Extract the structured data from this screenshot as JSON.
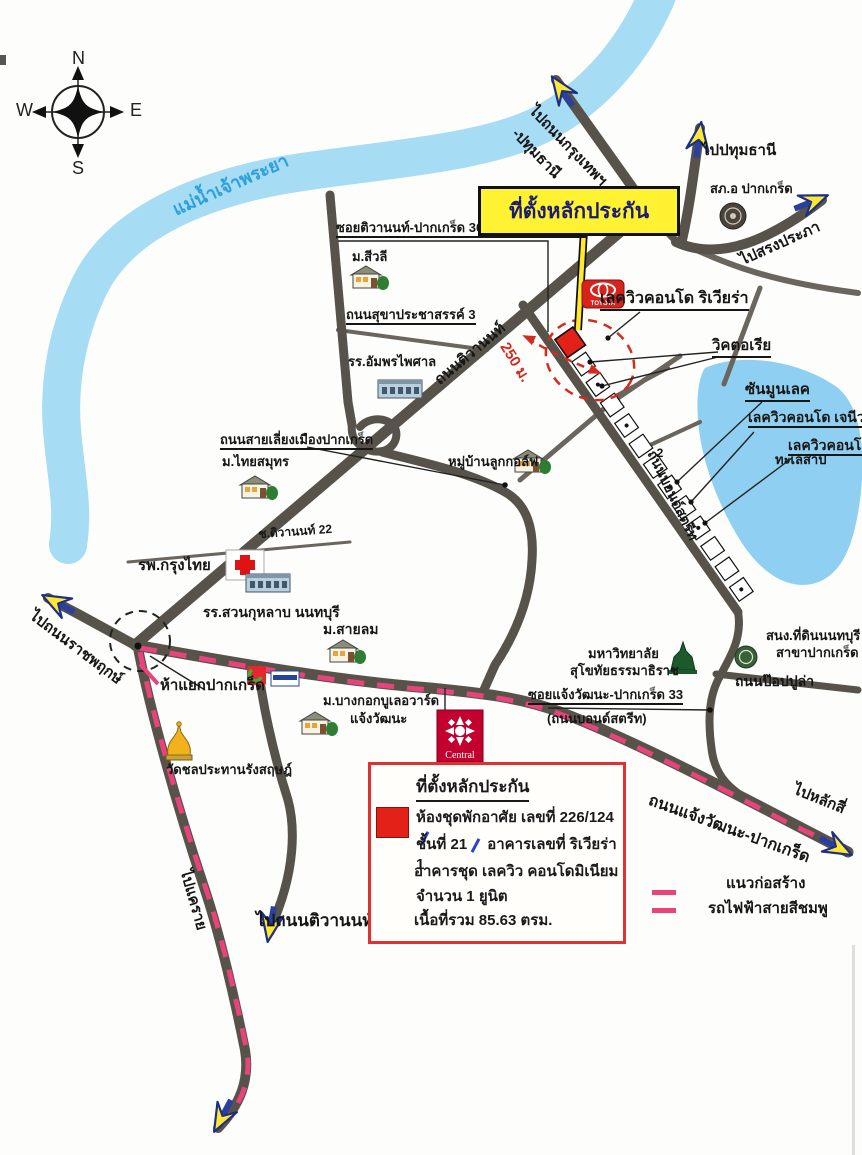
{
  "compass": {
    "north": "N",
    "south": "S",
    "east": "E",
    "west": "W"
  },
  "river_label": "แม่น้ำเจ้าพระยา",
  "title_box": "ที่ตั้งหลักประกัน",
  "directions": {
    "to_bangkok_line1": "ไปถนนกรุงเทพฯ",
    "to_bangkok_line2": "-ปทุมธานี",
    "to_pathumthani": "ไปปทุมธานี",
    "to_songprapha": "ไปสรงประภา",
    "to_ratchaphruek": "ไปถนนราชพฤกษ์",
    "to_laksi": "ไปหลักสี่",
    "to_khaerai": "ไปแคราย",
    "to_tiwanon_road": "ไปถนนติวานนท์"
  },
  "roads": {
    "soi_tiwanon_36": "ซอยติวานนท์-ปากเกร็ด 36 (ถนนบอนด์สตรีท)",
    "sukhaprachasan_3": "ถนนสุขาประชาสรรค์ 3",
    "tiwanon": "ถนนติวานนท์",
    "distance_250m": "250 ม.",
    "bypass": "ถนนสายเลี่ยงเมืองปากเกร็ด",
    "soi_tiwanon_22": "ช.ติวานนท์ 22",
    "bond_street": "ถนนบอนด์สตรีท",
    "chaengwattana": "ถนนแจ้งวัฒนะ-ปากเกร็ด",
    "popular": "ถนนป๊อปปูล่า",
    "soi_chaengwattana_33": "ซอยแจ้งวัฒนะ-ปากเกร็ด 33",
    "soi_chaengwattana_33_sub": "(ถนนบอนด์สตรีท)"
  },
  "places": {
    "police_station": "สภ.อ ปากเกร็ด",
    "sivalee_village": "ม.สีวลี",
    "amphon_school": "รร.อัมพรไพศาล",
    "lakeview_riviera": "เลควิวคอนโด ริเวียร่า",
    "victoria": "วิคตอเรีย",
    "sun_moon_lake": "ซันมูนเลค",
    "lakeview_geneva": "เลควิวคอนโด เจนีวา",
    "lakeview_condo": "เลควิวคอนโด",
    "lake": "ทะเลสาป",
    "thai_samut_village": "ม.ไทยสมุทร",
    "golf_village": "หมู่บ้านลูกกอล์ฟ",
    "krungthai_hospital": "รพ.กรุงไทย",
    "suankularb_school": "รร.สวนกุหลาบ นนทบุรี",
    "sailom_village": "ม.สายลม",
    "pakkret_junction": "ห้าแยกปากเกร็ด",
    "wat_chonprathan": "วัดชลประทานรังสฤษฎ์",
    "bangkok_boulevard_line1": "ม.บางกอกบูเลอวาร์ด",
    "bangkok_boulevard_line2": "แจ้งวัฒนะ",
    "stou_line1": "มหาวิทยาลัย",
    "stou_line2": "สุโขทัยธรรมาธิราช",
    "land_office_line1": "สนง.ที่ดินนนทบุรี",
    "land_office_line2": "สาขาปากเกร็ด",
    "block_2": "2",
    "toyota": "TOYOTA",
    "central": "Central"
  },
  "legend": {
    "line1": "แนวก่อสร้าง",
    "line2": "รถไฟฟ้าสายสีชมพู"
  },
  "info_box": {
    "title": "ที่ตั้งหลักประกัน",
    "line1": "ห้องชุดพักอาศัย เลขที่ 226/124",
    "line2a": "ชั้นที่ 21",
    "line2b": "อาคารเลขที่ ริเวียร่า 1",
    "line3": "อาคารชุด เลควิว คอนโดมิเนียม",
    "line4": "จำนวน 1 ยูนิต",
    "line5": "เนื้อที่รวม 85.63 ตรม."
  },
  "colors": {
    "river": "#a6dcf4",
    "lake": "#8fd0f2",
    "road": "#57534b",
    "pink_line": "#e8437a",
    "marker_red": "#e32119",
    "highlight_yellow": "#fff233"
  }
}
